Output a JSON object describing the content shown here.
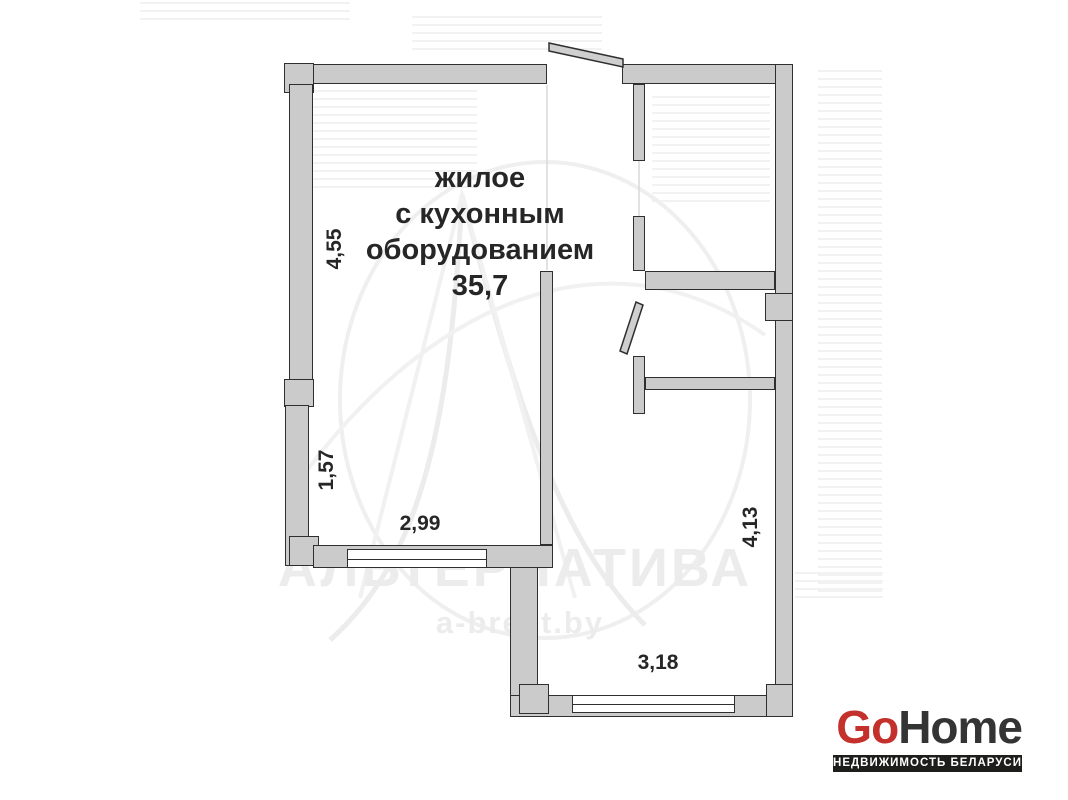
{
  "plan": {
    "room_label": {
      "line1": "жилое",
      "line2": "с кухонным",
      "line3": "оборудованием",
      "area": "35,7"
    },
    "dimensions": {
      "left_upper_wall": "4,55",
      "left_lower_wall": "1,57",
      "main_room_width": "2,99",
      "right_corridor_height": "4,13",
      "bottom_room_width": "3,18"
    }
  },
  "watermark": {
    "title": "АЛЬТЕРНАТИВА",
    "site": "a-brest.by"
  },
  "logo": {
    "go": "Go",
    "home": "Home",
    "tagline": "НЕДВИЖИМОСТЬ БЕЛАРУСИ"
  },
  "colors": {
    "wall_fill": "#cbcbcb",
    "wall_outline": "#2f2f2f",
    "label_text": "#262626",
    "watermark_gray": "#ececec",
    "logo_red": "#c4302b",
    "logo_dark": "#343434",
    "logo_bar_bg": "#1d1d1b"
  }
}
